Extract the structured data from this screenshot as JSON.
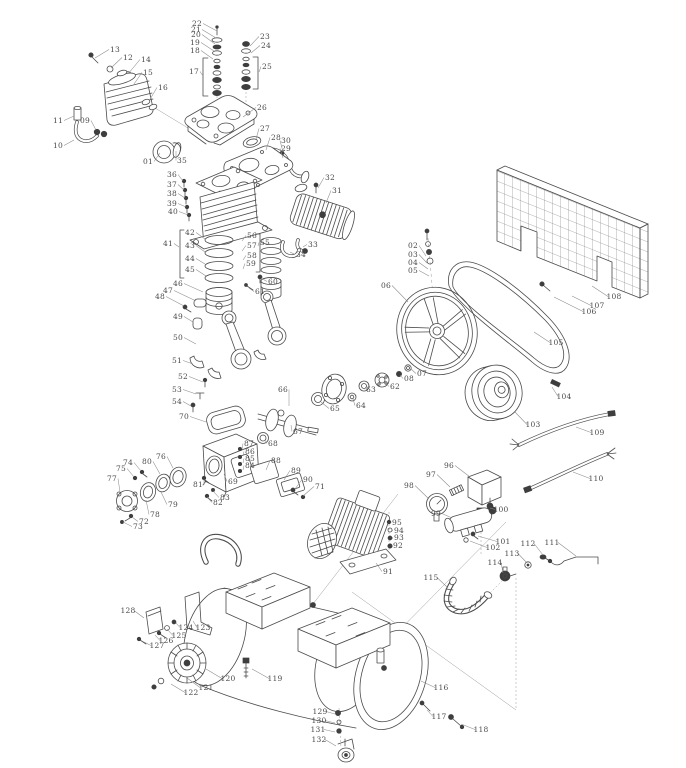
{
  "diagram": {
    "type": "exploded-parts-diagram",
    "background": "#ffffff",
    "line_color": "#4b4b4b",
    "leader_color": "#8c8c8c",
    "label_color": "#4a4a4a",
    "labels": [
      {
        "id": "01",
        "x": 148,
        "y": 164,
        "lx": 160,
        "ly": 153
      },
      {
        "id": "02",
        "x": 413,
        "y": 248,
        "lx": 426,
        "ly": 256
      },
      {
        "id": "03",
        "x": 413,
        "y": 257,
        "lx": 427,
        "ly": 263
      },
      {
        "id": "04",
        "x": 413,
        "y": 265,
        "lx": 428,
        "ly": 269
      },
      {
        "id": "05",
        "x": 413,
        "y": 273,
        "lx": 429,
        "ly": 276
      },
      {
        "id": "06",
        "x": 386,
        "y": 288,
        "lx": 408,
        "ly": 302
      },
      {
        "id": "07",
        "x": 422,
        "y": 376,
        "lx": 411,
        "ly": 369
      },
      {
        "id": "08",
        "x": 409,
        "y": 381,
        "lx": 400,
        "ly": 375
      },
      {
        "id": "09",
        "x": 85,
        "y": 123,
        "lx": 96,
        "ly": 130
      },
      {
        "id": "10",
        "x": 58,
        "y": 148,
        "lx": 74,
        "ly": 140
      },
      {
        "id": "11",
        "x": 58,
        "y": 123,
        "lx": 74,
        "ly": 116
      },
      {
        "id": "12",
        "x": 128,
        "y": 60,
        "lx": 111,
        "ly": 68
      },
      {
        "id": "13",
        "x": 115,
        "y": 52,
        "lx": 95,
        "ly": 58
      },
      {
        "id": "14",
        "x": 146,
        "y": 62,
        "lx": 128,
        "ly": 74
      },
      {
        "id": "15",
        "x": 148,
        "y": 75,
        "lx": 134,
        "ly": 84
      },
      {
        "id": "16",
        "x": 163,
        "y": 90,
        "lx": 149,
        "ly": 101
      },
      {
        "id": "17",
        "x": 194,
        "y": 74,
        "lx": 203,
        "ly": 76
      },
      {
        "id": "18",
        "x": 195,
        "y": 53,
        "lx": 213,
        "ly": 59
      },
      {
        "id": "19",
        "x": 195,
        "y": 45,
        "lx": 214,
        "ly": 51
      },
      {
        "id": "20",
        "x": 196,
        "y": 37,
        "lx": 215,
        "ly": 44
      },
      {
        "id": "21",
        "x": 196,
        "y": 32,
        "lx": 216,
        "ly": 38
      },
      {
        "id": "22",
        "x": 197,
        "y": 26,
        "lx": 217,
        "ly": 31
      },
      {
        "id": "23",
        "x": 265,
        "y": 39,
        "lx": 250,
        "ly": 46
      },
      {
        "id": "24",
        "x": 266,
        "y": 48,
        "lx": 251,
        "ly": 53
      },
      {
        "id": "25",
        "x": 267,
        "y": 69,
        "lx": 259,
        "ly": 72
      },
      {
        "id": "26",
        "x": 262,
        "y": 110,
        "lx": 243,
        "ly": 117
      },
      {
        "id": "27",
        "x": 265,
        "y": 131,
        "lx": 256,
        "ly": 139
      },
      {
        "id": "28",
        "x": 276,
        "y": 140,
        "lx": 266,
        "ly": 150
      },
      {
        "id": "29",
        "x": 286,
        "y": 151,
        "lx": 283,
        "ly": 158
      },
      {
        "id": "30",
        "x": 286,
        "y": 143,
        "lx": 283,
        "ly": 152
      },
      {
        "id": "31",
        "x": 337,
        "y": 193,
        "lx": 326,
        "ly": 203
      },
      {
        "id": "32",
        "x": 330,
        "y": 180,
        "lx": 318,
        "ly": 188
      },
      {
        "id": "33",
        "x": 313,
        "y": 247,
        "lx": 303,
        "ly": 247
      },
      {
        "id": "34",
        "x": 301,
        "y": 257,
        "lx": 290,
        "ly": 252
      },
      {
        "id": "35",
        "x": 182,
        "y": 163,
        "lx": 176,
        "ly": 151
      },
      {
        "id": "36",
        "x": 172,
        "y": 177,
        "lx": 183,
        "ly": 181
      },
      {
        "id": "37",
        "x": 172,
        "y": 187,
        "lx": 184,
        "ly": 190
      },
      {
        "id": "38",
        "x": 172,
        "y": 196,
        "lx": 185,
        "ly": 198
      },
      {
        "id": "39",
        "x": 172,
        "y": 206,
        "lx": 186,
        "ly": 207
      },
      {
        "id": "40",
        "x": 173,
        "y": 214,
        "lx": 188,
        "ly": 215
      },
      {
        "id": "41",
        "x": 168,
        "y": 246,
        "lx": 179,
        "ly": 247
      },
      {
        "id": "42",
        "x": 190,
        "y": 235,
        "lx": 205,
        "ly": 239
      },
      {
        "id": "43",
        "x": 190,
        "y": 248,
        "lx": 205,
        "ly": 252
      },
      {
        "id": "44",
        "x": 190,
        "y": 261,
        "lx": 205,
        "ly": 264
      },
      {
        "id": "45",
        "x": 190,
        "y": 272,
        "lx": 206,
        "ly": 276
      },
      {
        "id": "46",
        "x": 178,
        "y": 286,
        "lx": 203,
        "ly": 292
      },
      {
        "id": "47",
        "x": 168,
        "y": 293,
        "lx": 196,
        "ly": 301
      },
      {
        "id": "48",
        "x": 160,
        "y": 299,
        "lx": 184,
        "ly": 306
      },
      {
        "id": "49",
        "x": 178,
        "y": 319,
        "lx": 193,
        "ly": 322
      },
      {
        "id": "50",
        "x": 178,
        "y": 340,
        "lx": 196,
        "ly": 344
      },
      {
        "id": "51",
        "x": 177,
        "y": 363,
        "lx": 193,
        "ly": 364
      },
      {
        "id": "52",
        "x": 183,
        "y": 379,
        "lx": 203,
        "ly": 382
      },
      {
        "id": "53",
        "x": 177,
        "y": 392,
        "lx": 196,
        "ly": 394
      },
      {
        "id": "54",
        "x": 177,
        "y": 404,
        "lx": 191,
        "ly": 406
      },
      {
        "id": "55",
        "x": 265,
        "y": 245,
        "lx": 258,
        "ly": 246
      },
      {
        "id": "56",
        "x": 252,
        "y": 238,
        "lx": 242,
        "ly": 241
      },
      {
        "id": "57",
        "x": 252,
        "y": 248,
        "lx": 242,
        "ly": 251
      },
      {
        "id": "58",
        "x": 252,
        "y": 258,
        "lx": 243,
        "ly": 260
      },
      {
        "id": "59",
        "x": 251,
        "y": 266,
        "lx": 243,
        "ly": 269
      },
      {
        "id": "60",
        "x": 273,
        "y": 284,
        "lx": 261,
        "ly": 278
      },
      {
        "id": "61",
        "x": 260,
        "y": 294,
        "lx": 249,
        "ly": 288
      },
      {
        "id": "62",
        "x": 395,
        "y": 389,
        "lx": 385,
        "ly": 382
      },
      {
        "id": "63",
        "x": 371,
        "y": 392,
        "lx": 365,
        "ly": 388
      },
      {
        "id": "64",
        "x": 361,
        "y": 408,
        "lx": 353,
        "ly": 399
      },
      {
        "id": "65",
        "x": 335,
        "y": 411,
        "lx": 321,
        "ly": 402
      },
      {
        "id": "66",
        "x": 283,
        "y": 392,
        "lx": 289,
        "ly": 406
      },
      {
        "id": "67",
        "x": 298,
        "y": 434,
        "lx": 291,
        "ly": 425
      },
      {
        "id": "68",
        "x": 273,
        "y": 446,
        "lx": 265,
        "ly": 440
      },
      {
        "id": "69",
        "x": 233,
        "y": 484,
        "lx": 224,
        "ly": 474
      },
      {
        "id": "70",
        "x": 184,
        "y": 419,
        "lx": 206,
        "ly": 422
      },
      {
        "id": "71",
        "x": 320,
        "y": 489,
        "lx": 303,
        "ly": 496
      },
      {
        "id": "72",
        "x": 144,
        "y": 524,
        "lx": 132,
        "ly": 517
      },
      {
        "id": "73",
        "x": 138,
        "y": 529,
        "lx": 123,
        "ly": 522
      },
      {
        "id": "74",
        "x": 128,
        "y": 465,
        "lx": 141,
        "ly": 471
      },
      {
        "id": "75",
        "x": 121,
        "y": 471,
        "lx": 134,
        "ly": 477
      },
      {
        "id": "76",
        "x": 161,
        "y": 459,
        "lx": 173,
        "ly": 468
      },
      {
        "id": "77",
        "x": 112,
        "y": 481,
        "lx": 120,
        "ly": 492
      },
      {
        "id": "78",
        "x": 155,
        "y": 517,
        "lx": 146,
        "ly": 500
      },
      {
        "id": "79",
        "x": 173,
        "y": 507,
        "lx": 161,
        "ly": 492
      },
      {
        "id": "80",
        "x": 147,
        "y": 464,
        "lx": 160,
        "ly": 474
      },
      {
        "id": "81",
        "x": 198,
        "y": 487,
        "lx": 204,
        "ly": 479
      },
      {
        "id": "82",
        "x": 218,
        "y": 505,
        "lx": 207,
        "ly": 497
      },
      {
        "id": "83",
        "x": 225,
        "y": 500,
        "lx": 213,
        "ly": 491
      },
      {
        "id": "84",
        "x": 250,
        "y": 468,
        "lx": 243,
        "ly": 470
      },
      {
        "id": "85",
        "x": 250,
        "y": 461,
        "lx": 243,
        "ly": 463
      },
      {
        "id": "86",
        "x": 250,
        "y": 454,
        "lx": 243,
        "ly": 456
      },
      {
        "id": "87",
        "x": 249,
        "y": 446,
        "lx": 242,
        "ly": 449
      },
      {
        "id": "88",
        "x": 276,
        "y": 463,
        "lx": 266,
        "ly": 470
      },
      {
        "id": "89",
        "x": 296,
        "y": 473,
        "lx": 284,
        "ly": 480
      },
      {
        "id": "90",
        "x": 308,
        "y": 482,
        "lx": 295,
        "ly": 489
      },
      {
        "id": "91",
        "x": 388,
        "y": 574,
        "lx": 376,
        "ly": 563
      },
      {
        "id": "92",
        "x": 398,
        "y": 548,
        "lx": 392,
        "ly": 546
      },
      {
        "id": "93",
        "x": 399,
        "y": 540,
        "lx": 392,
        "ly": 539
      },
      {
        "id": "94",
        "x": 399,
        "y": 533,
        "lx": 392,
        "ly": 531
      },
      {
        "id": "95",
        "x": 397,
        "y": 525,
        "lx": 391,
        "ly": 523
      },
      {
        "id": "96",
        "x": 449,
        "y": 468,
        "lx": 470,
        "ly": 477
      },
      {
        "id": "97",
        "x": 431,
        "y": 477,
        "lx": 450,
        "ly": 487
      },
      {
        "id": "98",
        "x": 409,
        "y": 488,
        "lx": 429,
        "ly": 499
      },
      {
        "id": "99",
        "x": 436,
        "y": 516,
        "lx": 452,
        "ly": 518
      },
      {
        "id": "100",
        "x": 501,
        "y": 512,
        "lx": 490,
        "ly": 508
      },
      {
        "id": "101",
        "x": 503,
        "y": 544,
        "lx": 478,
        "ly": 536
      },
      {
        "id": "102",
        "x": 493,
        "y": 550,
        "lx": 470,
        "ly": 541
      },
      {
        "id": "103",
        "x": 533,
        "y": 427,
        "lx": 515,
        "ly": 412
      },
      {
        "id": "104",
        "x": 564,
        "y": 399,
        "lx": 552,
        "ly": 387
      },
      {
        "id": "105",
        "x": 556,
        "y": 345,
        "lx": 534,
        "ly": 332
      },
      {
        "id": "106",
        "x": 589,
        "y": 314,
        "lx": 554,
        "ly": 297
      },
      {
        "id": "107",
        "x": 597,
        "y": 308,
        "lx": 572,
        "ly": 296
      },
      {
        "id": "108",
        "x": 614,
        "y": 299,
        "lx": 592,
        "ly": 286
      },
      {
        "id": "109",
        "x": 597,
        "y": 435,
        "lx": 576,
        "ly": 427
      },
      {
        "id": "110",
        "x": 596,
        "y": 481,
        "lx": 573,
        "ly": 472
      },
      {
        "id": "111",
        "x": 552,
        "y": 545,
        "lx": 576,
        "ly": 556
      },
      {
        "id": "112",
        "x": 528,
        "y": 546,
        "lx": 543,
        "ly": 555
      },
      {
        "id": "113",
        "x": 512,
        "y": 556,
        "lx": 527,
        "ly": 563
      },
      {
        "id": "114",
        "x": 495,
        "y": 565,
        "lx": 503,
        "ly": 573
      },
      {
        "id": "115",
        "x": 431,
        "y": 580,
        "lx": 448,
        "ly": 588
      },
      {
        "id": "116",
        "x": 441,
        "y": 690,
        "lx": 421,
        "ly": 681
      },
      {
        "id": "117",
        "x": 439,
        "y": 719,
        "lx": 427,
        "ly": 710
      },
      {
        "id": "118",
        "x": 481,
        "y": 732,
        "lx": 461,
        "ly": 724
      },
      {
        "id": "119",
        "x": 275,
        "y": 681,
        "lx": 252,
        "ly": 669
      },
      {
        "id": "120",
        "x": 228,
        "y": 681,
        "lx": 206,
        "ly": 669
      },
      {
        "id": "121",
        "x": 206,
        "y": 690,
        "lx": 187,
        "ly": 678
      },
      {
        "id": "122",
        "x": 191,
        "y": 695,
        "lx": 171,
        "ly": 684
      },
      {
        "id": "123",
        "x": 203,
        "y": 630,
        "lx": 193,
        "ly": 621
      },
      {
        "id": "124",
        "x": 186,
        "y": 630,
        "lx": 176,
        "ly": 623
      },
      {
        "id": "125",
        "x": 179,
        "y": 638,
        "lx": 167,
        "ly": 629
      },
      {
        "id": "126",
        "x": 166,
        "y": 643,
        "lx": 155,
        "ly": 635
      },
      {
        "id": "127",
        "x": 157,
        "y": 648,
        "lx": 142,
        "ly": 641
      },
      {
        "id": "128",
        "x": 128,
        "y": 613,
        "lx": 144,
        "ly": 618
      },
      {
        "id": "129",
        "x": 320,
        "y": 714,
        "lx": 335,
        "ly": 714
      },
      {
        "id": "130",
        "x": 319,
        "y": 723,
        "lx": 335,
        "ly": 723
      },
      {
        "id": "131",
        "x": 318,
        "y": 732,
        "lx": 335,
        "ly": 732
      },
      {
        "id": "132",
        "x": 319,
        "y": 742,
        "lx": 336,
        "ly": 746
      }
    ]
  }
}
